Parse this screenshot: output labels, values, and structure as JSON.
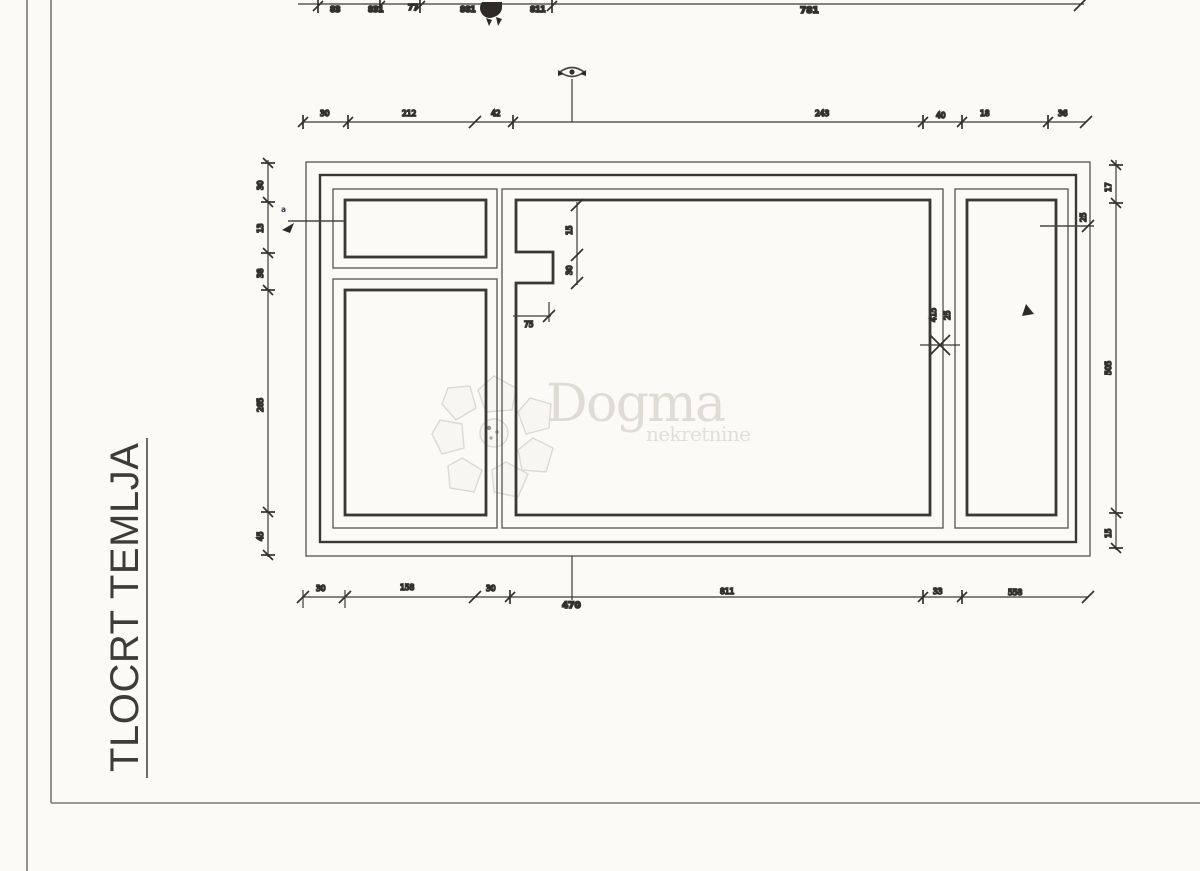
{
  "title": {
    "text": "TLOCRT TEMLJA"
  },
  "watermark": {
    "name": "Dogma",
    "subtitle": "nekretnine"
  },
  "colors": {
    "ink": "#3a3833",
    "ink_light": "#6b6760",
    "label_navy": "#3f3a52",
    "watermark_gray": "#dcd9d3",
    "paper": "#fbfaf7"
  },
  "dims": {
    "top1": [
      "83",
      "831",
      "77",
      "881",
      "811",
      "781"
    ],
    "top2": [
      "30",
      "212",
      "42",
      "243",
      "40",
      "18",
      "36"
    ],
    "bottom": [
      "30",
      "158",
      "30",
      "811",
      "33",
      "558"
    ],
    "bottom_total": "470",
    "left": [
      "30",
      "13",
      "38",
      "265",
      "45"
    ],
    "right": [
      "17",
      "505",
      "15"
    ],
    "right_inner": "25",
    "notch_v": [
      "15",
      "30"
    ],
    "notch_h": "75",
    "divider": [
      "415",
      "25"
    ],
    "leader": "a"
  }
}
